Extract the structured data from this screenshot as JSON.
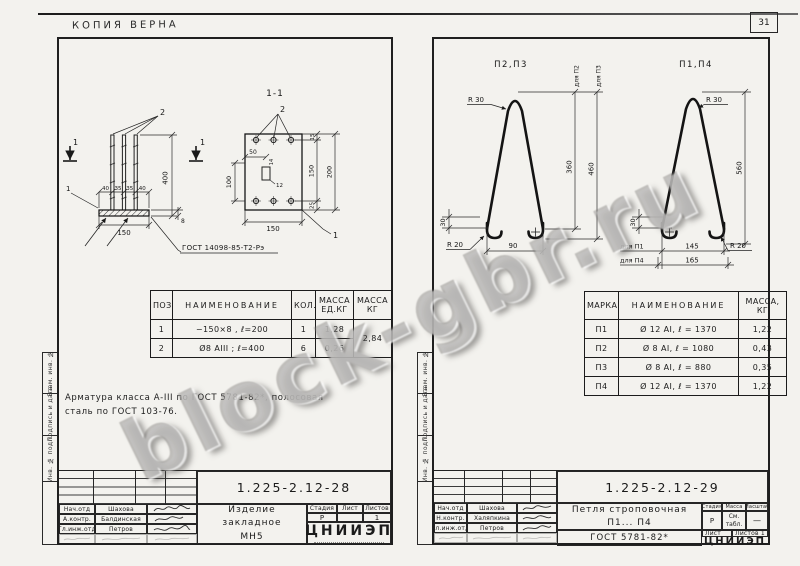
{
  "header": {
    "copy_note": "КОПИЯ ВЕРНА",
    "sheet_number": "31"
  },
  "watermark": "block-gbr.ru",
  "margin_stamp": {
    "col_top": "Взам. инв. №",
    "col_mid": "Подпись и дата",
    "col_bottom": "Инв. № подл."
  },
  "left_page": {
    "section_title": "1-1",
    "section_mark": "1",
    "callout_plate": "1",
    "callout_bars": "2",
    "weld_note": "ГОСТ 14098-85-Т2-Рэ",
    "dims": {
      "spacing": [
        "40",
        "35",
        "35",
        "40"
      ],
      "width": "150",
      "height": "400",
      "thick": "8",
      "plan_50": "50",
      "plan_14": "14",
      "plan_12": "12",
      "plan_100": "100",
      "plan_150_bottom": "150",
      "plan_15": "15",
      "plan_150_right": "150",
      "plan_200": "200",
      "plan_25": "25"
    },
    "table": {
      "h_pos": "ПОЗ.",
      "h_name": "НАИМЕНОВАНИЕ",
      "h_qty": "КОЛ.",
      "h_unit_mass": "МАССА\nЕД.КГ",
      "h_mass": "МАССА\nКГ",
      "rows": [
        {
          "pos": "1",
          "name": "−150×8 , ℓ=200",
          "qty": "1",
          "unit_mass": "1,28"
        },
        {
          "pos": "2",
          "name": "Ø8 АIII ; ℓ=400",
          "qty": "6",
          "unit_mass": "0,26"
        }
      ],
      "total_mass": "2,84"
    },
    "note_line1": "Арматура класса А-III по ГОСТ 5781-82*, полосовая",
    "note_line2": "сталь по ГОСТ 103-76.",
    "title_block": {
      "doc_number": "1.225-2.12-28",
      "title_line1": "Изделие закладное",
      "title_line2": "МН5",
      "stage_label": "Стадия",
      "sheet_label": "Лист",
      "sheets_label": "Листов",
      "stage": "Р",
      "sheets": "1",
      "org": "ЦНИИЭП",
      "signers": [
        {
          "role": "Нач.отд",
          "name": "Шахова"
        },
        {
          "role": "А.контр.",
          "name": "Балдинская"
        },
        {
          "role": "Гл.инж.отд",
          "name": "Петров"
        }
      ]
    }
  },
  "right_page": {
    "loop_left_label": "П2,П3",
    "loop_right_label": "П1,П4",
    "dims": {
      "r30": "R 30",
      "r20": "R 20",
      "d30": "30",
      "d90": "90",
      "d360": "360",
      "d460": "460",
      "d560": "560",
      "d145": "145",
      "d165": "165",
      "for_p1": "для П1",
      "for_p2": "для П2",
      "for_p3": "для П3",
      "for_p4": "для П4"
    },
    "table": {
      "h_mark": "МАРКА",
      "h_name": "НАИМЕНОВАНИЕ",
      "h_mass": "МАССА,\nКГ",
      "rows": [
        {
          "mark": "П1",
          "name": "Ø 12 АI, ℓ = 1370",
          "mass": "1,22"
        },
        {
          "mark": "П2",
          "name": "Ø 8 АI, ℓ = 1080",
          "mass": "0,43"
        },
        {
          "mark": "П3",
          "name": "Ø 8 АI, ℓ = 880",
          "mass": "0,35"
        },
        {
          "mark": "П4",
          "name": "Ø 12 АI, ℓ = 1370",
          "mass": "1,22"
        }
      ]
    },
    "title_block": {
      "doc_number": "1.225-2.12-29",
      "title_line1": "Петля строповочная",
      "title_line2": "П1... П4",
      "gost": "ГОСТ 5781-82*",
      "stage_label": "Стадия",
      "mass_label": "Масса",
      "scale_label": "Масштаб",
      "stage": "Р",
      "mass_value": "См.\nтабл.",
      "scale": "—",
      "sheet_label": "Лист",
      "sheets_label": "Листов",
      "sheets": "1",
      "org": "ЦНИИЭП",
      "signers": [
        {
          "role": "Нач.отд",
          "name": "Шахова"
        },
        {
          "role": "Н.контр.",
          "name": "Халяпкина"
        },
        {
          "role": "Гл.инж.отд",
          "name": "Петров"
        }
      ]
    }
  }
}
